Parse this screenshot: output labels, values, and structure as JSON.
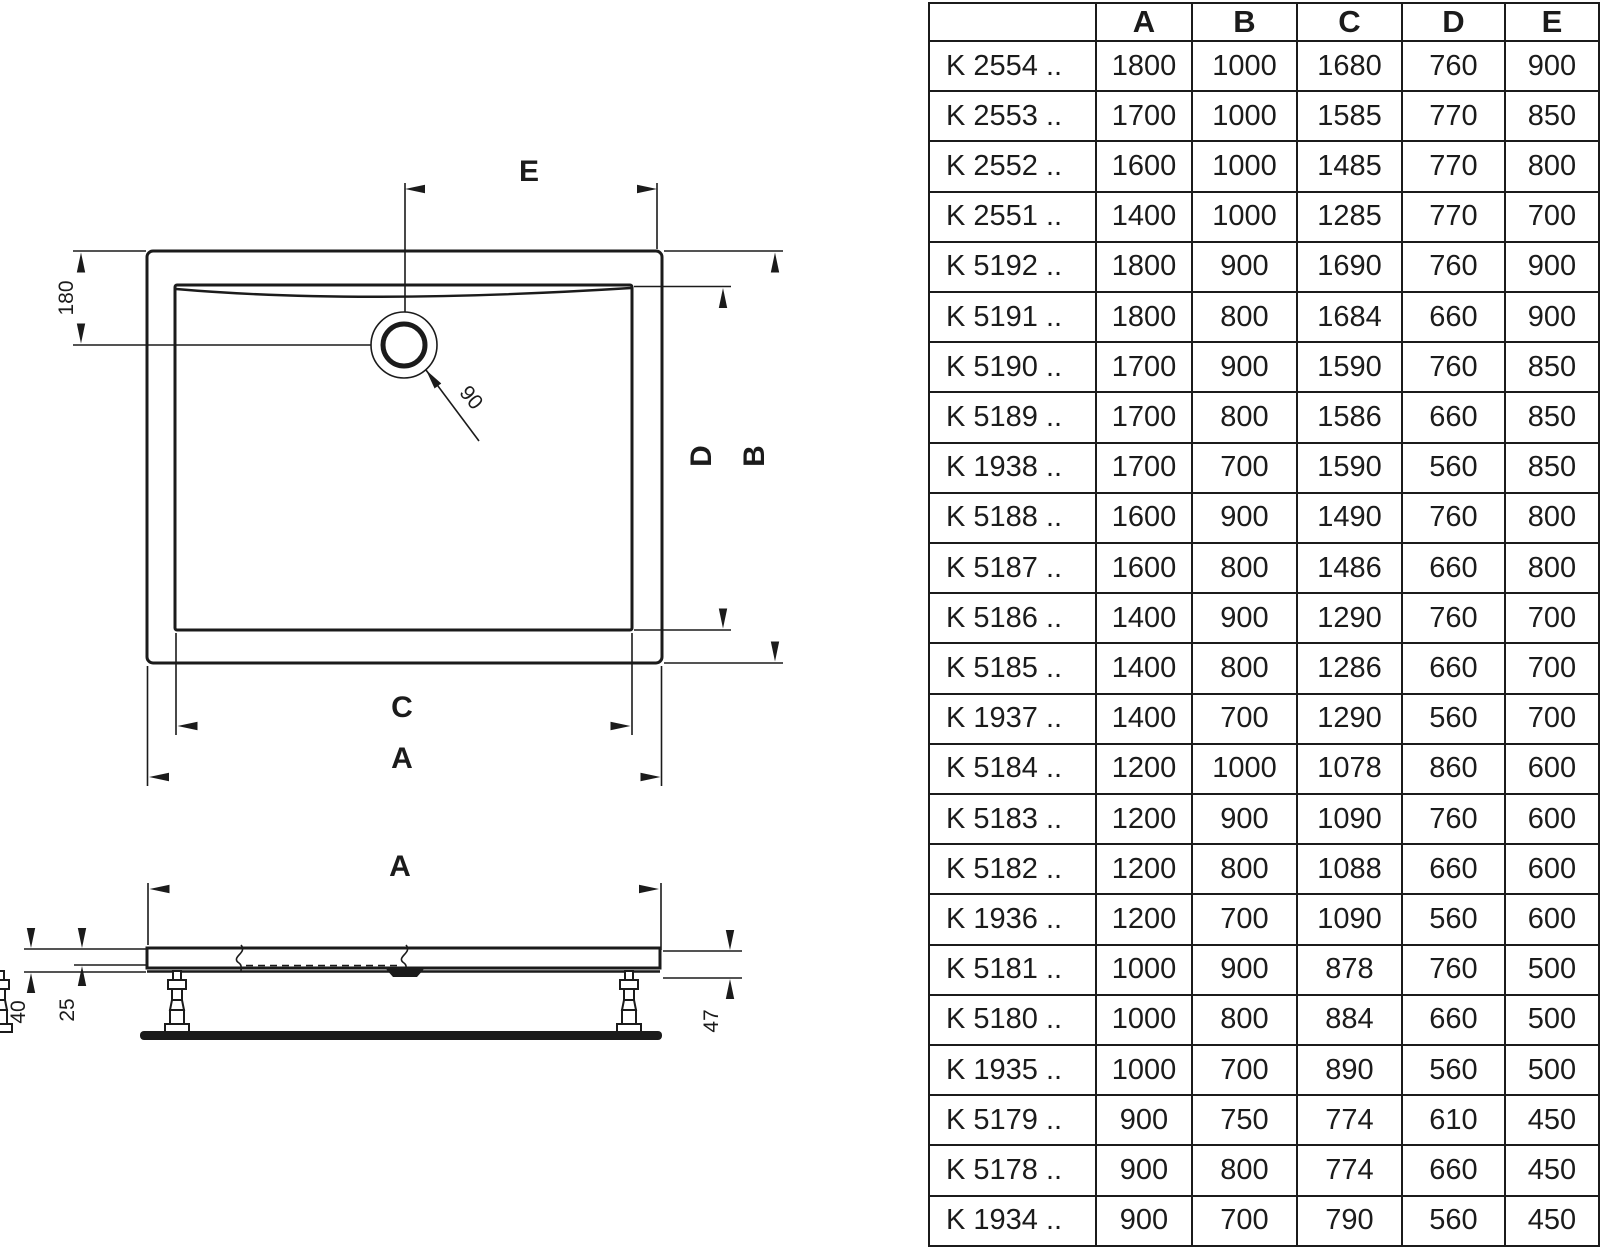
{
  "diagram": {
    "top_view": {
      "labels": {
        "e": "E",
        "offset_180": "180",
        "drain_90": "90",
        "d": "D",
        "b": "B",
        "c": "C",
        "a": "A"
      }
    },
    "side_view": {
      "labels": {
        "a": "A",
        "h40": "40",
        "h25": "25",
        "h47": "47"
      }
    }
  },
  "table": {
    "columns": [
      "",
      "A",
      "B",
      "C",
      "D",
      "E"
    ],
    "rows": [
      {
        "model": "K 2554 ..",
        "values": [
          "1800",
          "1000",
          "1680",
          "760",
          "900"
        ]
      },
      {
        "model": "K 2553 ..",
        "values": [
          "1700",
          "1000",
          "1585",
          "770",
          "850"
        ]
      },
      {
        "model": "K 2552 ..",
        "values": [
          "1600",
          "1000",
          "1485",
          "770",
          "800"
        ]
      },
      {
        "model": "K 2551 ..",
        "values": [
          "1400",
          "1000",
          "1285",
          "770",
          "700"
        ]
      },
      {
        "model": "K 5192 ..",
        "values": [
          "1800",
          "900",
          "1690",
          "760",
          "900"
        ]
      },
      {
        "model": "K 5191 ..",
        "values": [
          "1800",
          "800",
          "1684",
          "660",
          "900"
        ]
      },
      {
        "model": "K 5190 ..",
        "values": [
          "1700",
          "900",
          "1590",
          "760",
          "850"
        ]
      },
      {
        "model": "K 5189 ..",
        "values": [
          "1700",
          "800",
          "1586",
          "660",
          "850"
        ]
      },
      {
        "model": "K 1938 ..",
        "values": [
          "1700",
          "700",
          "1590",
          "560",
          "850"
        ]
      },
      {
        "model": "K 5188 ..",
        "values": [
          "1600",
          "900",
          "1490",
          "760",
          "800"
        ]
      },
      {
        "model": "K 5187 ..",
        "values": [
          "1600",
          "800",
          "1486",
          "660",
          "800"
        ]
      },
      {
        "model": "K 5186 ..",
        "values": [
          "1400",
          "900",
          "1290",
          "760",
          "700"
        ]
      },
      {
        "model": "K 5185 ..",
        "values": [
          "1400",
          "800",
          "1286",
          "660",
          "700"
        ]
      },
      {
        "model": "K 1937 ..",
        "values": [
          "1400",
          "700",
          "1290",
          "560",
          "700"
        ]
      },
      {
        "model": "K 5184 ..",
        "values": [
          "1200",
          "1000",
          "1078",
          "860",
          "600"
        ]
      },
      {
        "model": "K 5183 ..",
        "values": [
          "1200",
          "900",
          "1090",
          "760",
          "600"
        ]
      },
      {
        "model": "K 5182 ..",
        "values": [
          "1200",
          "800",
          "1088",
          "660",
          "600"
        ]
      },
      {
        "model": "K 1936 ..",
        "values": [
          "1200",
          "700",
          "1090",
          "560",
          "600"
        ]
      },
      {
        "model": "K 5181 ..",
        "values": [
          "1000",
          "900",
          "878",
          "760",
          "500"
        ]
      },
      {
        "model": "K 5180 ..",
        "values": [
          "1000",
          "800",
          "884",
          "660",
          "500"
        ]
      },
      {
        "model": "K 1935 ..",
        "values": [
          "1000",
          "700",
          "890",
          "560",
          "500"
        ]
      },
      {
        "model": "K 5179 ..",
        "values": [
          "900",
          "750",
          "774",
          "610",
          "450"
        ]
      },
      {
        "model": "K 5178 ..",
        "values": [
          "900",
          "800",
          "774",
          "660",
          "450"
        ]
      },
      {
        "model": "K 1934 ..",
        "values": [
          "900",
          "700",
          "790",
          "560",
          "450"
        ]
      }
    ]
  },
  "colors": {
    "ink": "#1b1b1b",
    "background": "#ffffff"
  }
}
